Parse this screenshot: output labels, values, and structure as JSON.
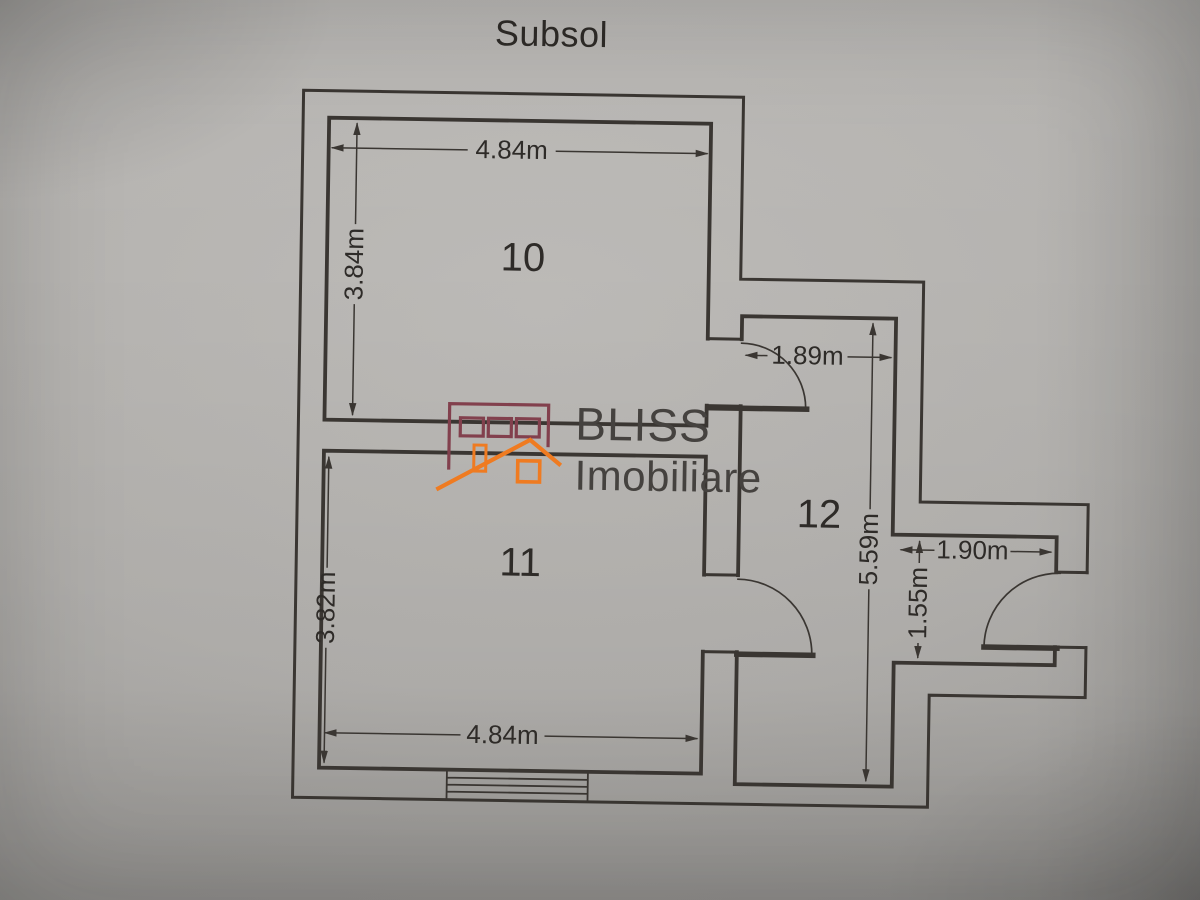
{
  "document": {
    "title": "Subsol"
  },
  "floorplan": {
    "rooms": [
      {
        "label": "10"
      },
      {
        "label": "11"
      },
      {
        "label": "12"
      }
    ],
    "dims": {
      "room10_width_top": "4.84m",
      "room10_height": "3.84m",
      "hall_top_width": "1.89m",
      "hall_height": "5.59m",
      "alcove_width": "1.90m",
      "alcove_height": "1.55m",
      "room11_height": "3.82m",
      "room11_width_bottom": "4.84m"
    },
    "colors": {
      "ink": "#3a3632",
      "text": "#2e2b28",
      "logo_red": "#82404d",
      "logo_orange": "#ef7b21",
      "logo_text": "#45423f"
    }
  },
  "watermark": {
    "brand": "BLISS",
    "tagline": "Imobiliare"
  }
}
